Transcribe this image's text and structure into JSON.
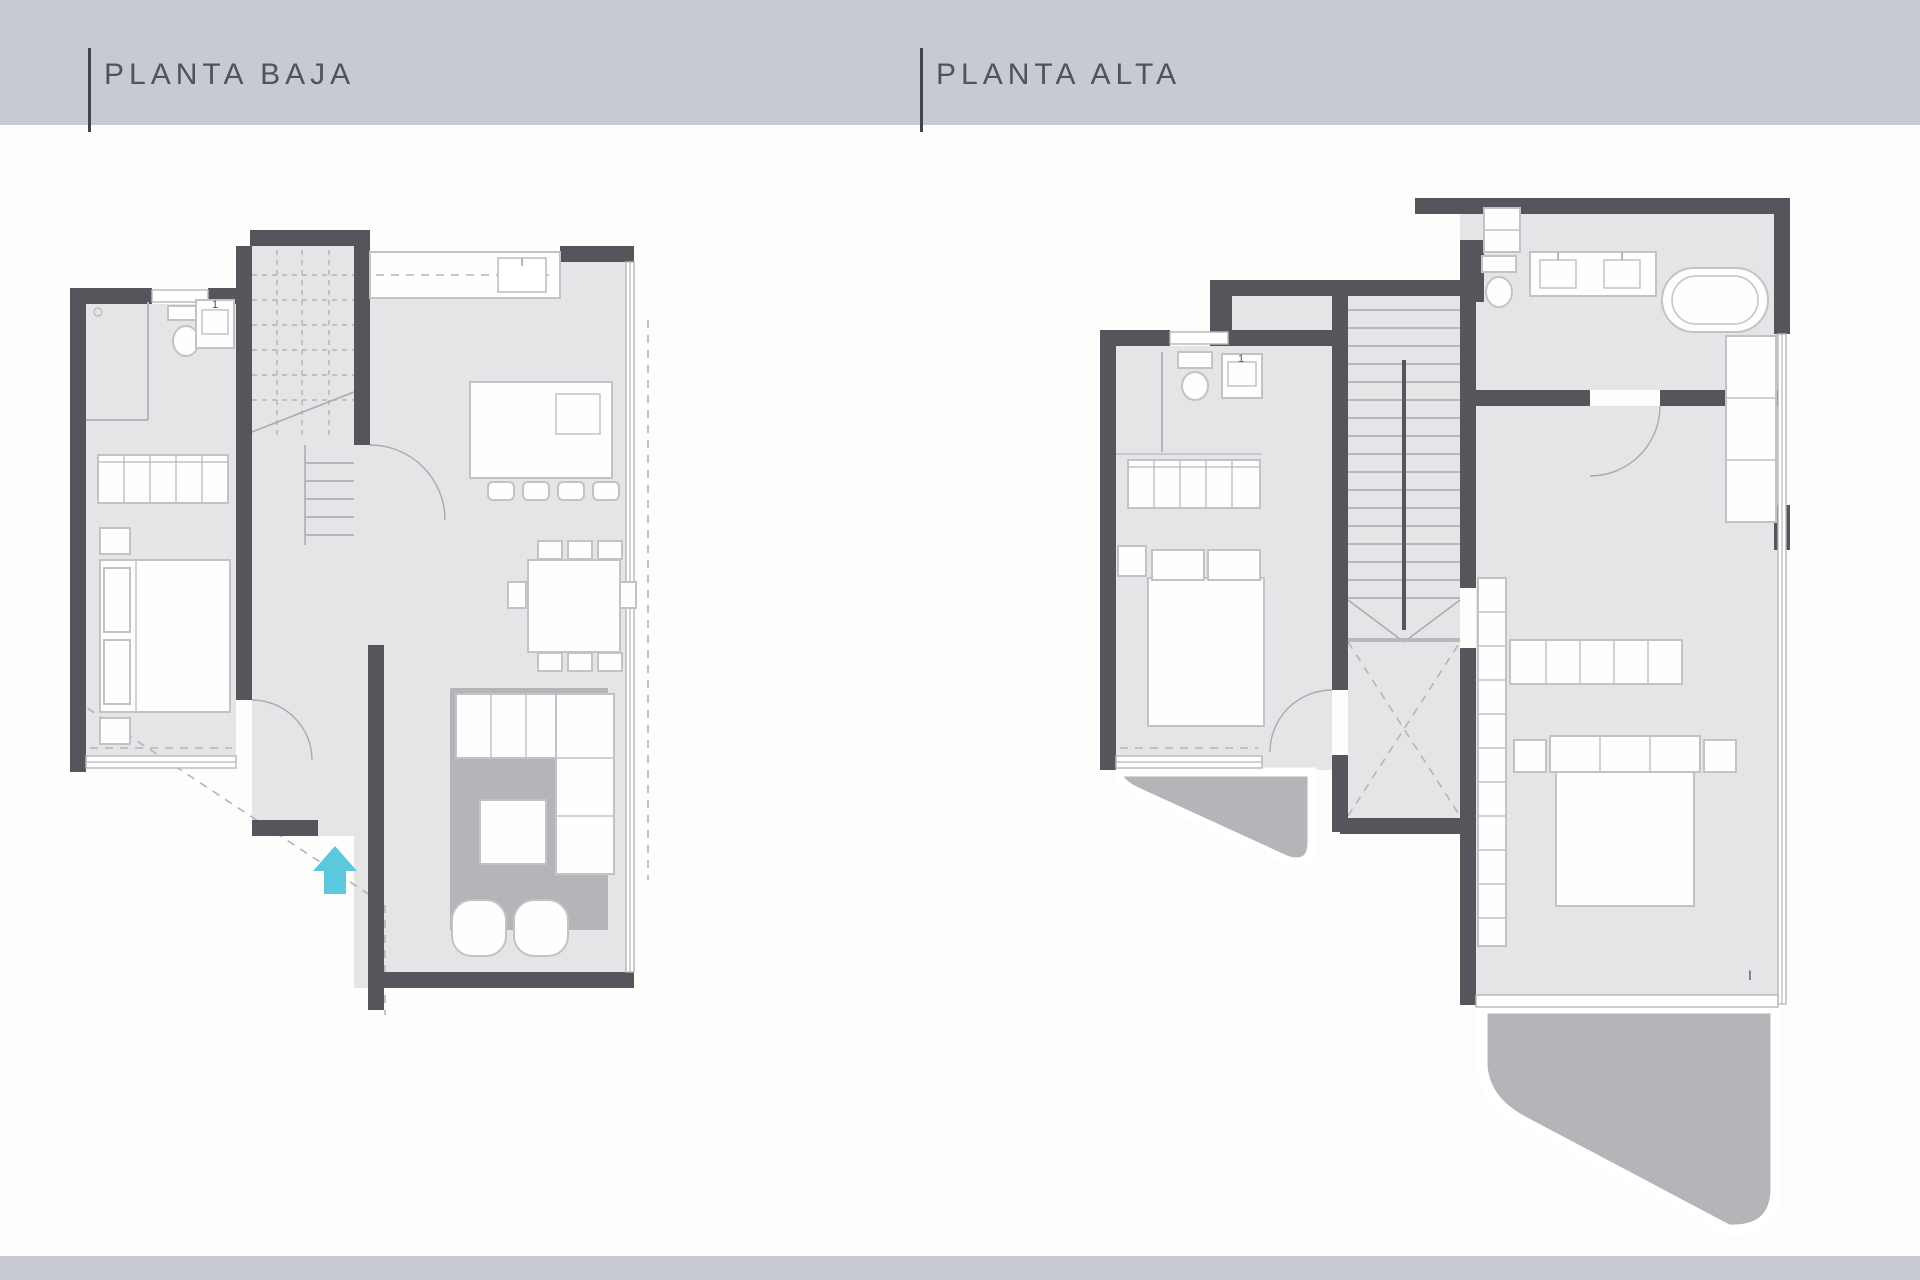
{
  "header": {
    "left_title": "PLANTA BAJA",
    "right_title": "PLANTA ALTA"
  },
  "markers": {
    "sink_faucet_left": "1",
    "sink_faucet_right": "1",
    "window_marker": "I"
  },
  "icons": {
    "entrance_arrow": "up-arrow"
  },
  "colors": {
    "band": "#c7cad1",
    "title": "#4e545f",
    "rule": "#3f4450",
    "wall": "#54565b",
    "floor": "#e4e5e7",
    "floor2": "#b4b5b8",
    "furn": "#fefefe",
    "furnstroke": "#c2c3c6",
    "line": "#b5b7ba",
    "dash": "#b3b5b8",
    "stair": "#a8aaad",
    "accent": "#5bc8de"
  }
}
